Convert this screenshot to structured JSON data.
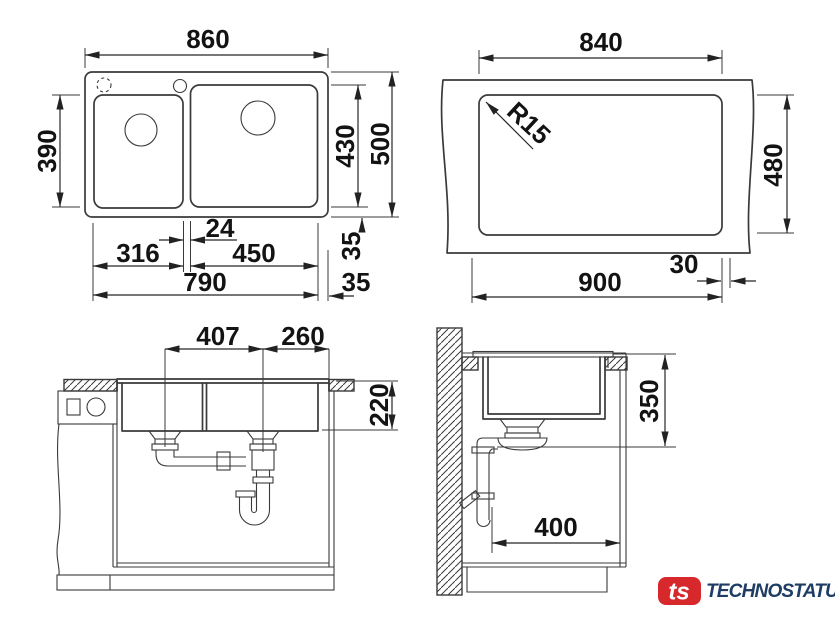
{
  "colors": {
    "line": "#3a3a3a",
    "text": "#131313"
  },
  "views": {
    "plan": {
      "label": "sink top view",
      "dims": {
        "overall_width": "860",
        "left_bowl_height": "390",
        "bowl_height": "430",
        "overall_depth": "500",
        "divider_width": "24",
        "left_bowl_width": "316",
        "right_bowl_width": "450",
        "inner_width": "790",
        "rim_side": "35",
        "rim_bottom": "35"
      }
    },
    "cutout": {
      "label": "worktop cutout view",
      "dims": {
        "cutout_width": "840",
        "corner_radius": "R15",
        "cutout_depth": "480",
        "base_width": "900",
        "edge_offset": "30"
      }
    },
    "front": {
      "label": "front section view",
      "dims": {
        "drain_spacing": "407",
        "drain_to_edge": "260",
        "bowl_depth": "220"
      }
    },
    "side": {
      "label": "side section view",
      "dims": {
        "height_below_worktop": "350",
        "wall_distance": "400"
      }
    }
  },
  "logo": {
    "mark": "ts",
    "name": "TECHNOSTATUS",
    "mark_color": "#d7282c",
    "name_color": "#1e3c64"
  }
}
